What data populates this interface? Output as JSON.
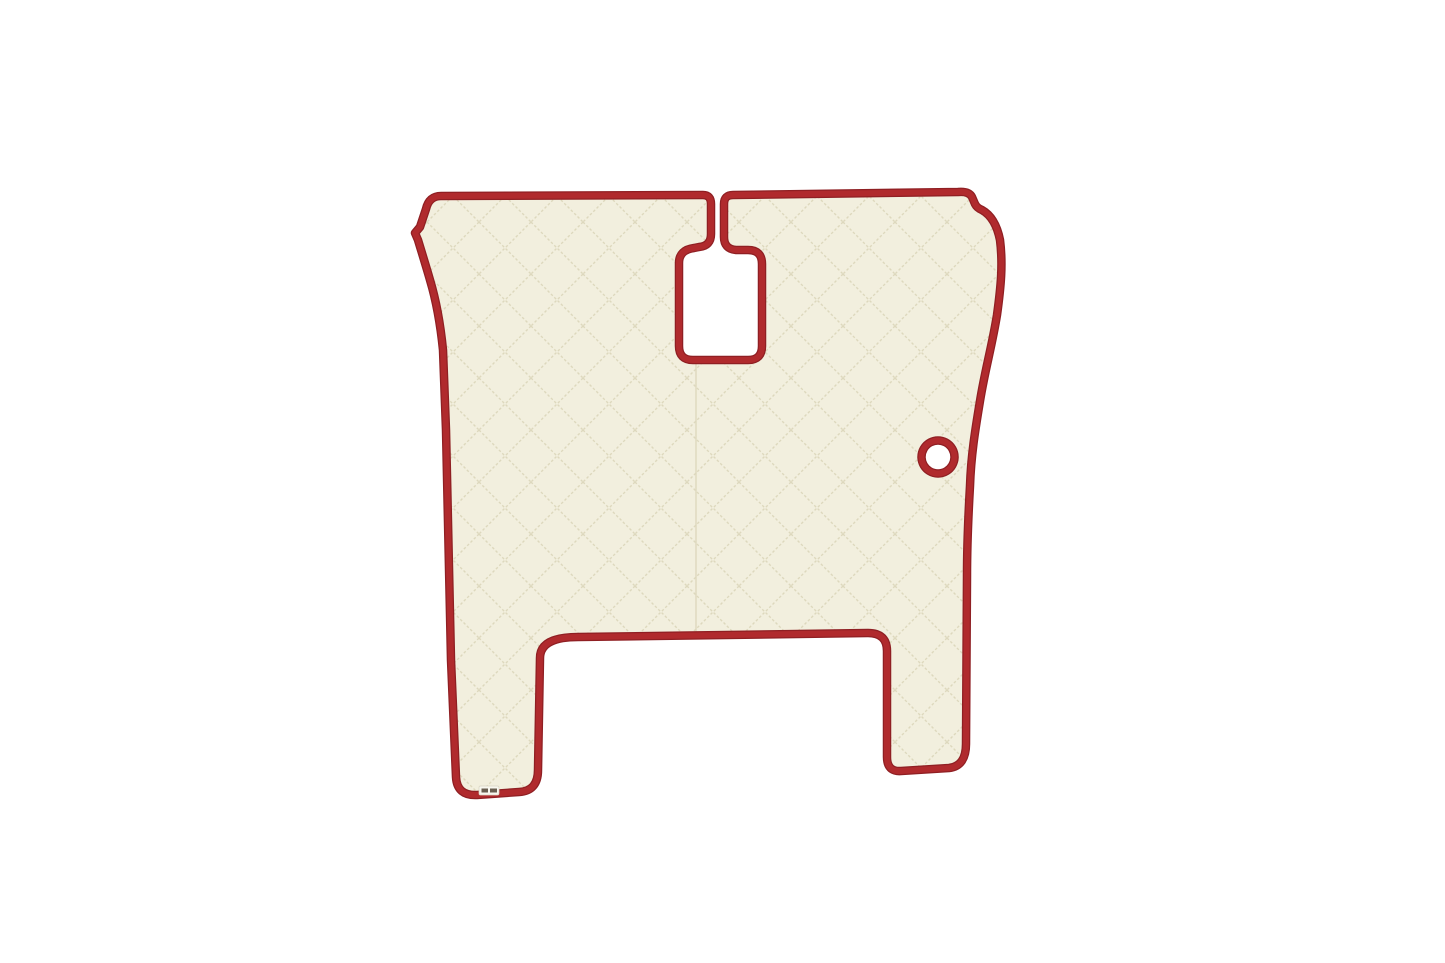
{
  "scene": {
    "description": "Product photo of a cream quilted eco-leather truck floor mat with red piping trim, a central gear-lever cut-out connected to the top edge by a slit, and a round cut-out on the right side",
    "background_color": "#ffffff"
  },
  "mat": {
    "colors": {
      "surface": "#f2efde",
      "stitching": "#ddd8bd",
      "piping": "#b02a2d",
      "piping_shadow": "#8f1f23"
    },
    "tag": {
      "background": "#f8f7ef",
      "text_color": "#6a5f51"
    }
  }
}
